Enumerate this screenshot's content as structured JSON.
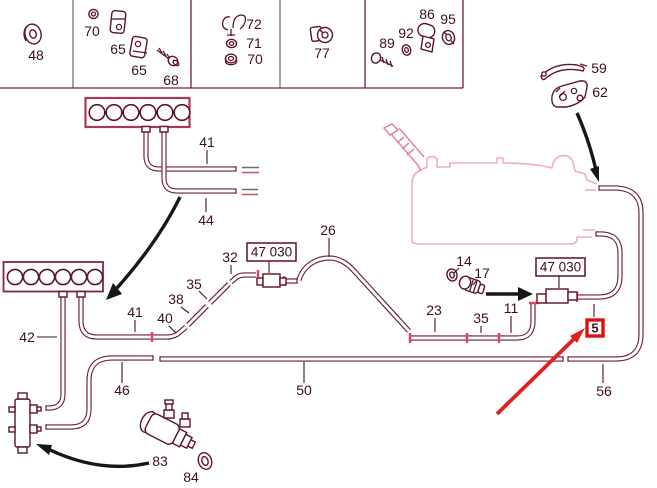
{
  "diagram_type": "parts-diagram-fuel-and-vacuum-lines",
  "colors": {
    "line": "#6b1d31",
    "text": "#3c1018",
    "engine_outline_pink": "#f2abbf",
    "filler_neck_pink": "#e2839f",
    "junction_tick_red": "#e8405c",
    "highlight_red": "#e02020",
    "badge_border_red": "#dd1111",
    "arrow_black": "#171717",
    "divider_grey": "#6f6f6f"
  },
  "legend_row": {
    "cells": [
      {
        "parts": [
          "48"
        ]
      },
      {
        "parts": [
          "70",
          "65",
          "65",
          "68"
        ]
      },
      {
        "parts": [
          "72",
          "71",
          "70"
        ]
      },
      {
        "parts": [
          "77"
        ]
      },
      {
        "parts": [
          "89",
          "92",
          "86",
          "95"
        ]
      }
    ]
  },
  "labels": {
    "p48": "48",
    "p70a": "70",
    "p65a": "65",
    "p65b": "65",
    "p68": "68",
    "p72": "72",
    "p71": "71",
    "p70b": "70",
    "p77": "77",
    "p89": "89",
    "p92": "92",
    "p86": "86",
    "p95": "95",
    "p41a": "41",
    "p44": "44",
    "p42": "42",
    "p41b": "41",
    "p40": "40",
    "p38": "38",
    "p35a": "35",
    "p32": "32",
    "p26": "26",
    "p46": "46",
    "p50": "50",
    "p23": "23",
    "p35b": "35",
    "p11": "11",
    "p14": "14",
    "p17": "17",
    "p56": "56",
    "p59": "59",
    "p62": "62",
    "p83": "83",
    "p84": "84",
    "box47030_a": "47 030",
    "box47030_b": "47 030",
    "badge5": "5"
  }
}
